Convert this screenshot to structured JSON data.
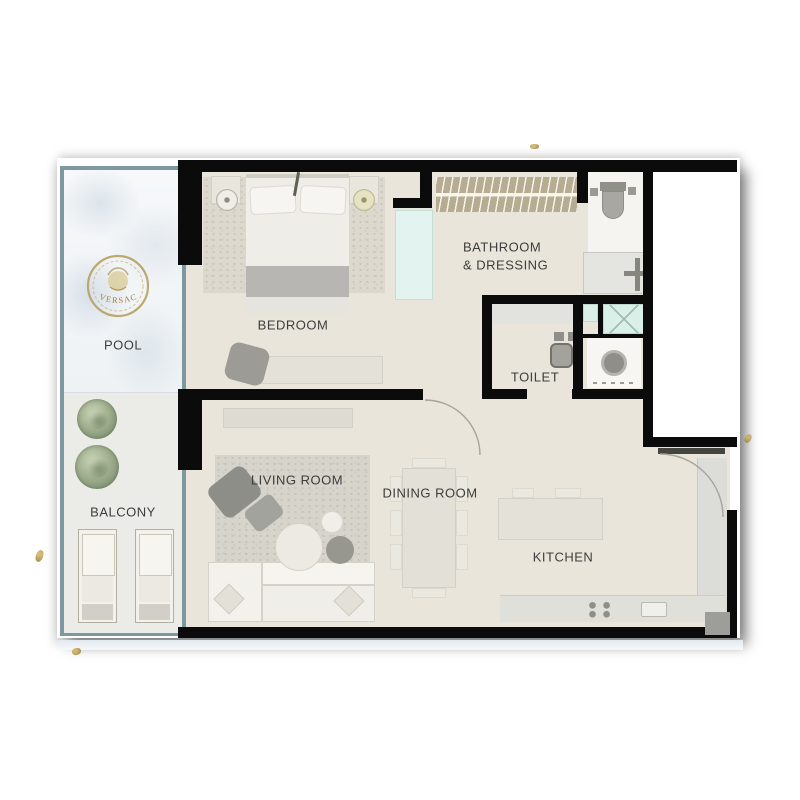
{
  "plan_type": "apartment-floor-plan",
  "branding": {
    "logo": "VERSACE"
  },
  "labels": {
    "pool": "POOL",
    "balcony": "BALCONY",
    "bedroom": "BEDROOM",
    "bathroom_line1": "BATHROOM",
    "bathroom_line2": "& DRESSING",
    "toilet": "TOILET",
    "living_room": "LIVING ROOM",
    "dining_room": "DINING ROOM",
    "kitchen": "KITCHEN"
  },
  "colors": {
    "wall": "#0b0b0b",
    "floor": "#e9e5da",
    "outdoor_frame": "#7e98a1",
    "glass": "#e3f4f0",
    "shower_glass": "#d9efe8",
    "gold": "#b39c57",
    "label_text": "#3d3d3d"
  }
}
